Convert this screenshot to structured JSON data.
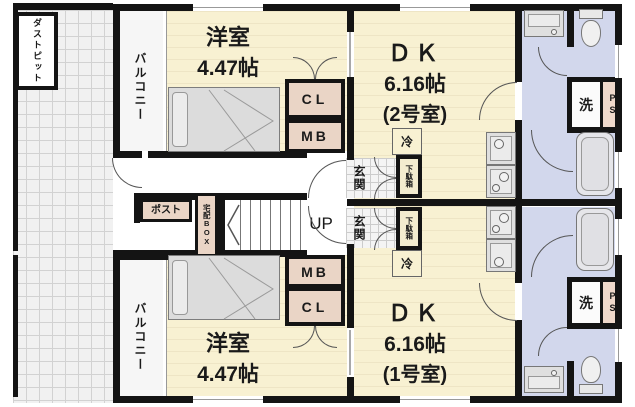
{
  "colors": {
    "wall": "#141414",
    "room_floor": "#F8F1D2",
    "wet_area": "#D2D7EC",
    "closet_pink": "#EAD5C6",
    "ps_pink": "#EFD9CB"
  },
  "site": {
    "dust_pit": "ダストピット"
  },
  "common_area": {
    "post": "ポスト",
    "delivery_box": "宅配BOX",
    "stairs_up": "UP"
  },
  "unit2": {
    "balcony": "バルコニー",
    "bedroom": "洋室",
    "bedroom_size": "4.47帖",
    "dk_label": "ＤＫ",
    "dk_size": "6.16帖",
    "room_number": "(2号室)",
    "closet": "CL",
    "meter_box": "MB",
    "fridge": "冷",
    "entrance": "玄関",
    "shoe_cabinet": "下駄箱",
    "laundry": "洗",
    "pipe_space": "PS"
  },
  "unit1": {
    "balcony": "バルコニー",
    "bedroom": "洋室",
    "bedroom_size": "4.47帖",
    "dk_label": "ＤＫ",
    "dk_size": "6.16帖",
    "room_number": "(1号室)",
    "closet": "CL",
    "meter_box": "MB",
    "fridge": "冷",
    "entrance": "玄関",
    "shoe_cabinet": "下駄箱",
    "laundry": "洗",
    "pipe_space": "PS"
  }
}
